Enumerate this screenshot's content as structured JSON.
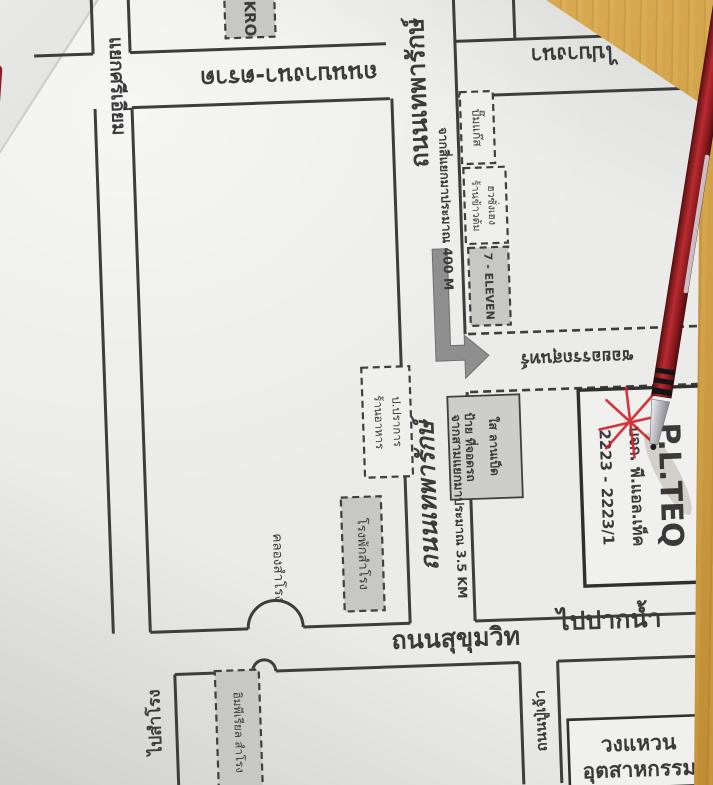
{
  "scene": {
    "desk_color": "#d2a249",
    "paper_color": "#ebebe9",
    "ink_color": "#3d3d3d",
    "accent_red": "#d32127"
  },
  "map": {
    "top": {
      "junction_label": "แยกศรีเอี่ยม",
      "makro": "KRO",
      "bangna_trat_road": "ถนนบางนา-ตราด",
      "to_bangna": "ไปบางนา",
      "thepharak_road_top": "ถนนเทพารักษ์",
      "distance_400": "จากสี่แยกมาประมาณ 400 M",
      "gas_station": "ปั๊มแก๊ส",
      "rice_shop_line1": "ร้านข้าวต้ม",
      "rice_shop_line2": "ฮวซั่งเฮง",
      "seven_eleven": "7 - ELEVEN"
    },
    "middle": {
      "soi_label": "ซอยอรรถสุนทร์",
      "thepharak_road_mid": "ถนนเทพารักษ์",
      "distance_3_5": "จากสามแยกมาประมาณ 3.5 KM",
      "restaurant_line1": "ร้านอาหาร",
      "restaurant_line2": "ป.ปราการ",
      "parking_line1": "ป้าย ที่จอดรถ",
      "parking_line2": "ใส ลานเป็ด",
      "police_station": "โรงพักสำโรง",
      "canal": "คลองสำโรง"
    },
    "destination": {
      "name_en": "P.L.TEQ",
      "name_th": "บจก. พี.แอล.เท็ค",
      "address": "2223 - 2223/1"
    },
    "bottom": {
      "sukhumvit_road": "ถนนสุขุมวิท",
      "to_paknam": "ไปปากน้ำ",
      "pu_chao_road": "ถนนปู่เจ้า",
      "to_samrong": "ไปสำโรง",
      "imperial": "อิมพีเรียล สำโรง",
      "ring_line1": "วงแหวน",
      "ring_line2": "อุตสาหกรรม"
    }
  }
}
